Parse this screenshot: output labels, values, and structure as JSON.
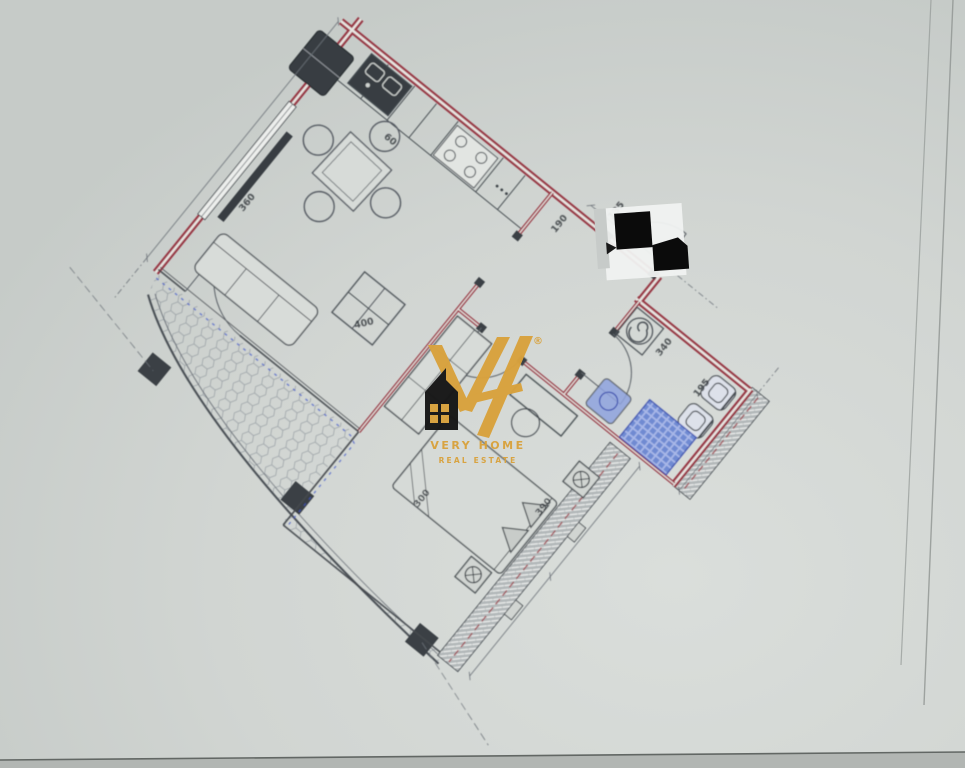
{
  "document": {
    "kind": "scanned-floor-plan-photo",
    "paper_color": "#d1d5d2",
    "wall_color": "#993744",
    "line_color": "#4a4f55",
    "fixture_blue": "#5f7fd6",
    "hatch_gray": "#b4babb",
    "redaction_black": "#0b0b0b"
  },
  "watermark": {
    "brand_initials": "VH",
    "registered_mark": "®",
    "line1": "VERY HOME",
    "line2": "REAL ESTATE",
    "gold": "#d9a23c"
  },
  "plan": {
    "rotation_deg": 39,
    "dimensions": {
      "left_wall": "360",
      "living_width": "400",
      "top_a": "135",
      "top_b": "140",
      "hall": "190",
      "bath_width": "340",
      "bath_depth": "195",
      "bedroom_width": "300",
      "bedroom_length": "390",
      "kitchen_small": "60"
    },
    "fixtures": [
      "kitchen-sink",
      "stove",
      "refrigerator",
      "dining-table",
      "sofa",
      "coffee-table",
      "radiator",
      "double-bed",
      "wardrobe",
      "toilet",
      "bidet",
      "washing-machine",
      "shower",
      "water-heater",
      "ceiling-spotlight",
      "balcony-pier"
    ]
  }
}
